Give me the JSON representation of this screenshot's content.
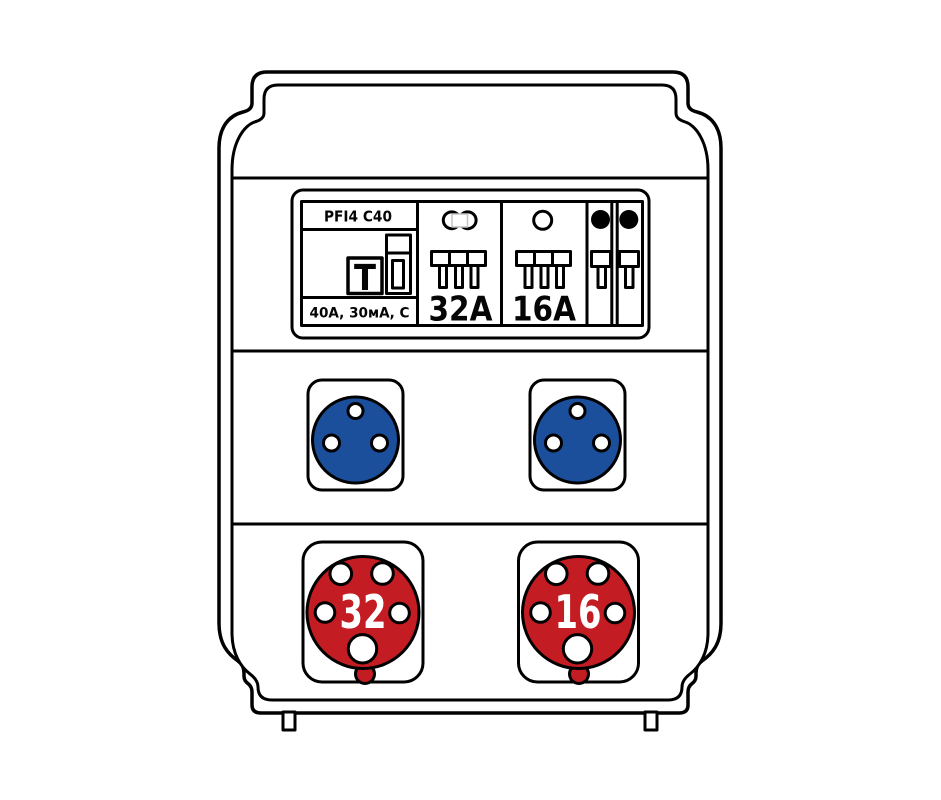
{
  "device": {
    "breaker_panel": {
      "rcd": {
        "model": "PFI4 C40",
        "rating": "40A, 30мА, C",
        "test_button": "T"
      },
      "breaker_32": {
        "label": "32A"
      },
      "breaker_16": {
        "label": "16A"
      }
    },
    "cee_sockets": {
      "left": {
        "label": "32"
      },
      "right": {
        "label": "16"
      }
    }
  },
  "colors": {
    "socket_blue": "#1b4e9b",
    "cee_red": "#c41c23",
    "line": "#000000",
    "background": "#ffffff"
  }
}
